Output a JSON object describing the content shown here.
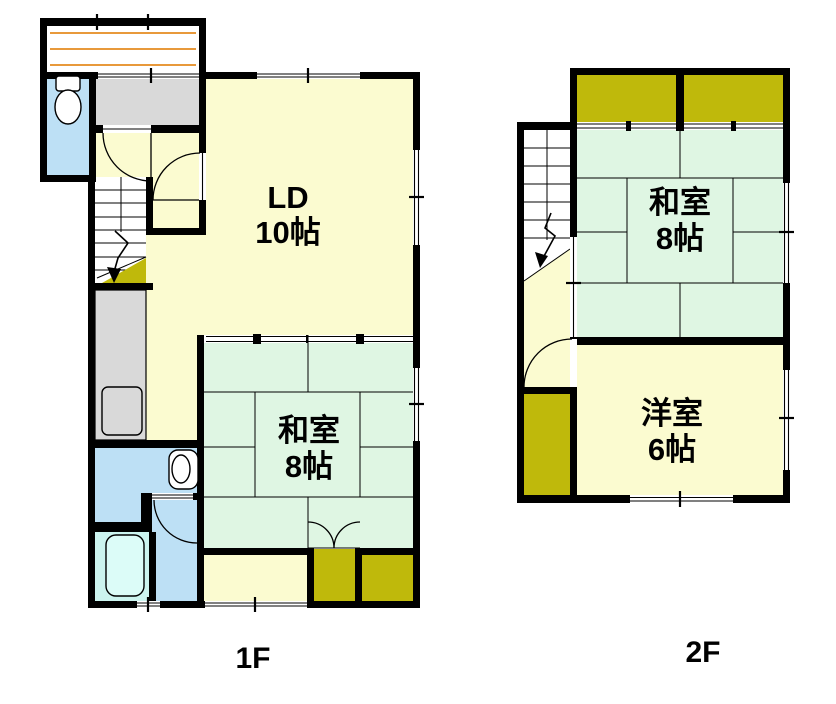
{
  "title": "2-story house floor plan",
  "colors": {
    "wall": "#000000",
    "room_yellow": "#FBFBD0",
    "tatami_green": "#DFF6E3",
    "closet_olive": "#BFB90B",
    "water_blue": "#BDE0F5",
    "bath_cyan": "#CCF4EF",
    "bathtub_fill": "#DCFCF8",
    "fixture_gray": "#D9D9D9",
    "deck_stripe": "#E8993B",
    "background": "#FFFFFF",
    "text": "#000000"
  },
  "floor1": {
    "label": "1F",
    "rooms": {
      "ld": {
        "name": "LD",
        "size": "10帖"
      },
      "washitsu": {
        "name": "和室",
        "size": "8帖"
      }
    },
    "fixtures": [
      "porch-deck",
      "toilet",
      "entrance",
      "hall",
      "stairs",
      "kitchen-counter",
      "washroom-sink",
      "bathtub",
      "closet",
      "closet"
    ]
  },
  "floor2": {
    "label": "2F",
    "rooms": {
      "washitsu": {
        "name": "和室",
        "size": "8帖"
      },
      "yoshitsu": {
        "name": "洋室",
        "size": "6帖"
      }
    },
    "fixtures": [
      "stairs",
      "hall",
      "closet",
      "closet",
      "closet"
    ]
  }
}
